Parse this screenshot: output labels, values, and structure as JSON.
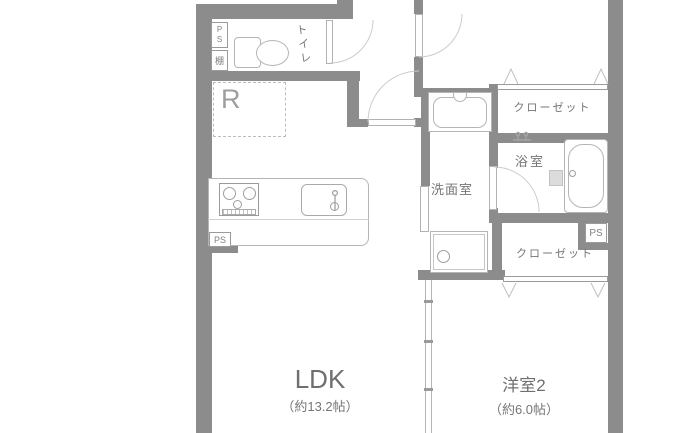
{
  "floorplan": {
    "rooms": {
      "ldk": {
        "label": "LDK",
        "size": "（約13.2帖）"
      },
      "bedroom2": {
        "label": "洋室2",
        "size": "（約6.0帖）"
      },
      "washroom": {
        "label": "洗面室"
      },
      "bathroom": {
        "label": "浴室"
      },
      "toilet": {
        "label": "トイレ"
      },
      "closet_upper": {
        "label": "クローゼット"
      },
      "closet_lower": {
        "label": "クローゼット"
      }
    },
    "fixtures": {
      "refrigerator_label": "R",
      "shelf_label": "棚",
      "pipe_space_toilet": "PS",
      "pipe_space_kitchen": "PS",
      "pipe_space_closet": "PS"
    },
    "colors": {
      "wall": "#8c8c8c",
      "fixture_line": "#b5b5b5",
      "text": "#757575",
      "text_light": "#9e9e9e",
      "background": "#ffffff"
    }
  }
}
